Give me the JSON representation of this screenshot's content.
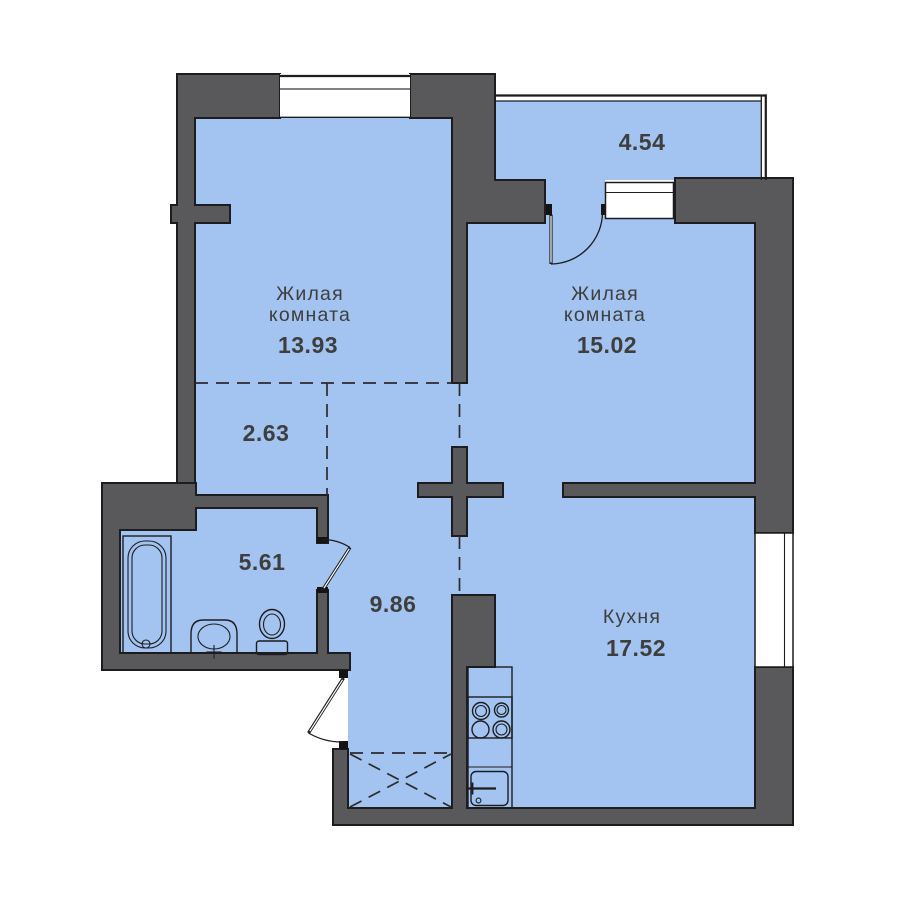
{
  "floor_plan": {
    "colors": {
      "floor": "#A3C3F0",
      "wall": "#59595B",
      "outline": "#1D1D1F",
      "text": "#3E3E3D",
      "window": "#FFFFFF"
    },
    "rooms": [
      {
        "id": "living-room-1",
        "label_lines": [
          "Жилая",
          "комната"
        ],
        "area": "13.93"
      },
      {
        "id": "living-room-2",
        "label_lines": [
          "Жилая",
          "комната"
        ],
        "area": "15.02"
      },
      {
        "id": "kitchen",
        "label_lines": [
          "Кухня"
        ],
        "area": "17.52"
      },
      {
        "id": "bathroom",
        "area": "5.61"
      },
      {
        "id": "hallway",
        "area": "2.63"
      },
      {
        "id": "corridor",
        "area": "9.86"
      },
      {
        "id": "balcony",
        "area": "4.54"
      }
    ],
    "fixtures": [
      "bathtub",
      "washbasin",
      "toilet",
      "stove",
      "kitchen-sink",
      "wardrobe-zone"
    ]
  }
}
